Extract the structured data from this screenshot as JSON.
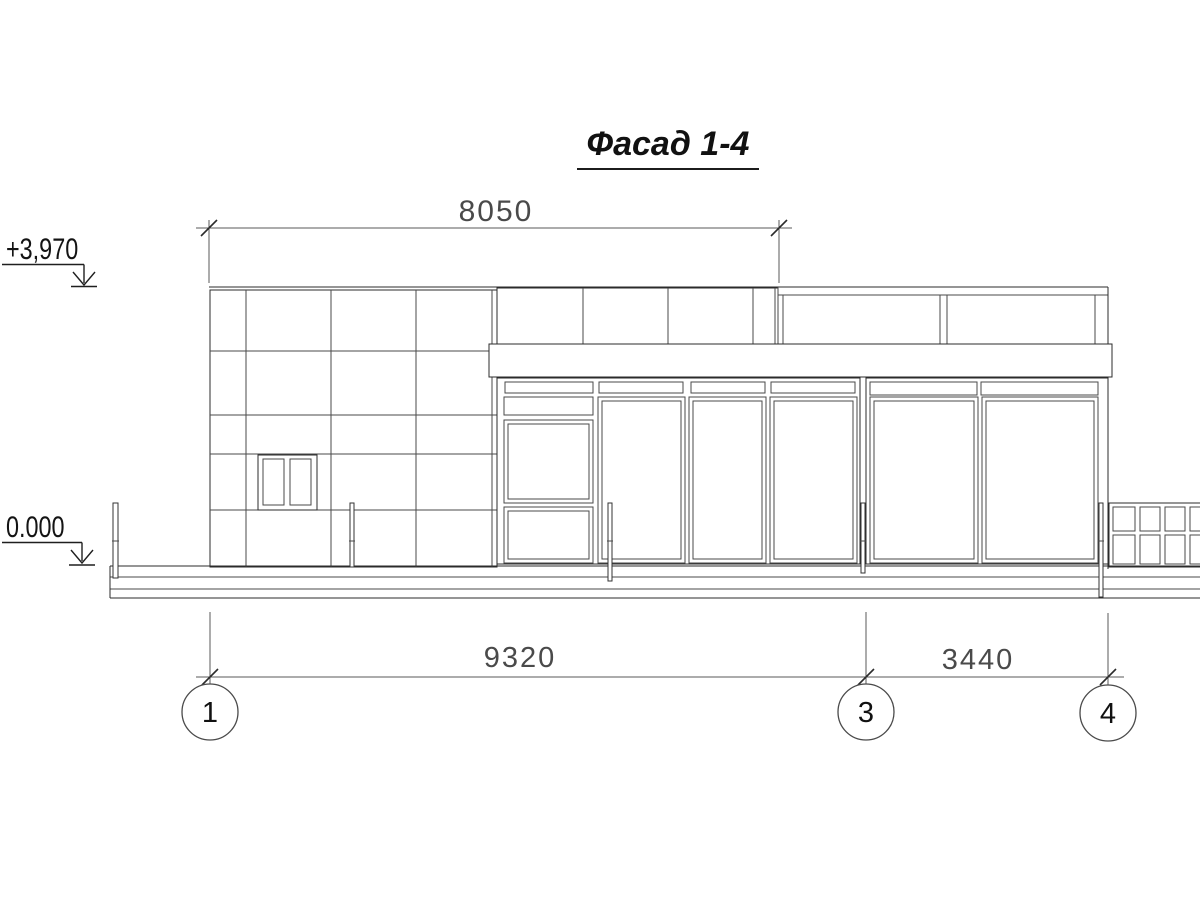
{
  "title": "Фасад 1-4",
  "dimensions": {
    "top_span": "8050",
    "span_1_3": "9320",
    "span_3_4": "3440"
  },
  "elevations": {
    "roof": "+3,970",
    "ground": "0.000"
  },
  "axes": {
    "first": "1",
    "middle": "3",
    "last": "4"
  },
  "colors": {
    "paper": "#ffffff",
    "line_heavy": "#1c1c1c",
    "line_medium": "#2b2b2b",
    "line_thin": "#4a4a4a",
    "line_dimension": "#5a5a5a",
    "text_primary": "#111111",
    "text_dimension": "#4a4a4a"
  }
}
